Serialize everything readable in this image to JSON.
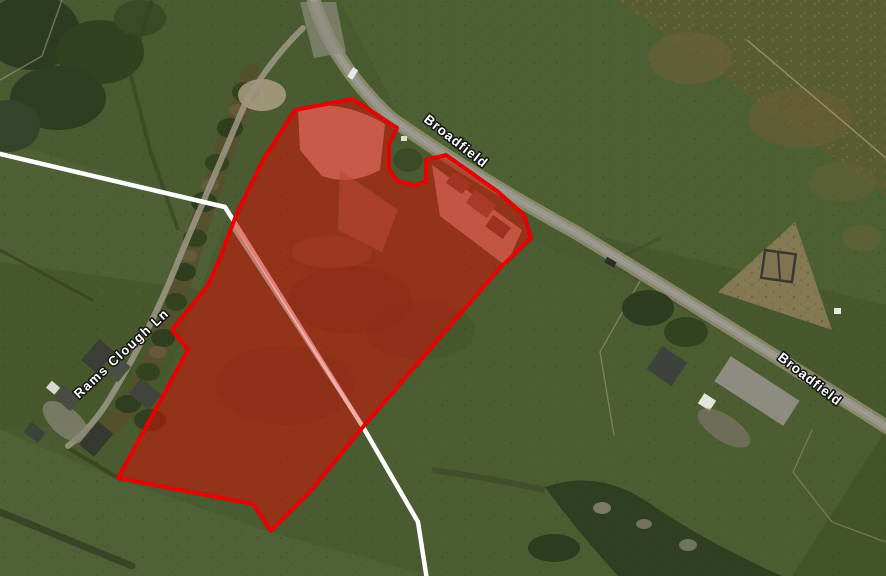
{
  "map": {
    "view_type": "satellite-aerial-view",
    "road_labels": [
      {
        "id": "broadfield-upper",
        "text": "Broadfield"
      },
      {
        "id": "broadfield-lower",
        "text": "Broadfield"
      },
      {
        "id": "rams-clough-ln",
        "text": "Rams Clough Ln"
      }
    ],
    "overlay": {
      "site_boundary_stroke": "#e60202",
      "site_boundary_fill": "#cf1207",
      "footpath_color": "#ffffff"
    }
  }
}
